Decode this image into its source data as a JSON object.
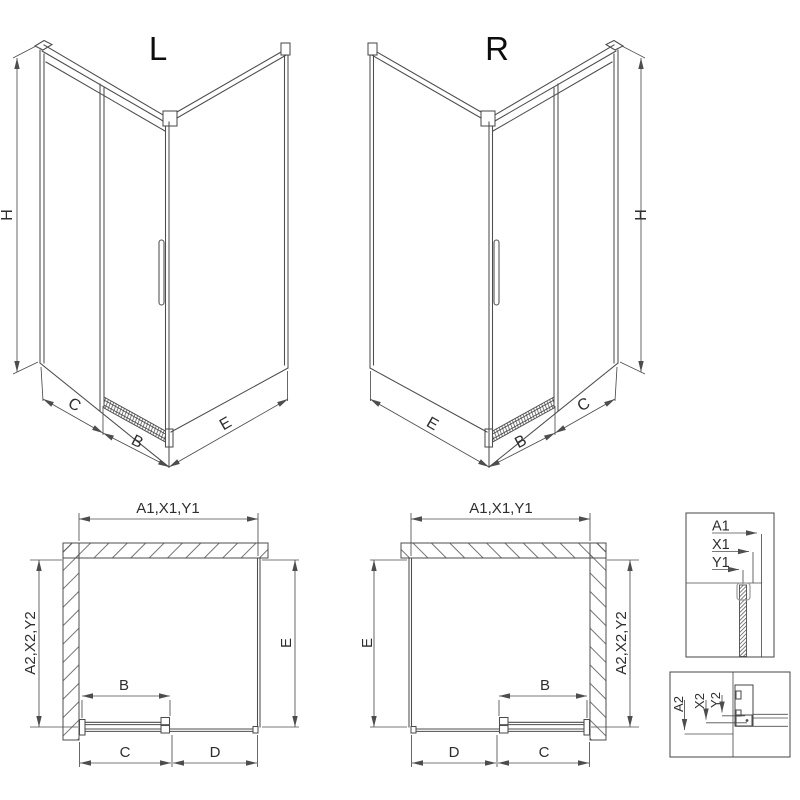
{
  "views_3d": {
    "left": {
      "title": "L",
      "height": "H",
      "seg_c": "C",
      "seg_b": "B",
      "seg_e": "E"
    },
    "right": {
      "title": "R",
      "height": "H",
      "seg_c": "C",
      "seg_b": "B",
      "seg_e": "E"
    }
  },
  "plans": {
    "left": {
      "width": "A1,X1,Y1",
      "depth": "A2,X2,Y2",
      "side": "E",
      "door": "B",
      "seg_c": "C",
      "seg_d": "D"
    },
    "right": {
      "width": "A1,X1,Y1",
      "depth": "A2,X2,Y2",
      "side": "E",
      "door": "B",
      "seg_c": "C",
      "seg_d": "D"
    }
  },
  "details": {
    "width_profile": {
      "a": "A1",
      "x": "X1",
      "y": "Y1"
    },
    "depth_profile": {
      "a": "A2",
      "x": "X2",
      "y": "Y2"
    }
  },
  "colors": {
    "line": "#4d4d4d",
    "text": "#2e2e2e",
    "title": "#0d0d0d",
    "background": "#ffffff"
  }
}
